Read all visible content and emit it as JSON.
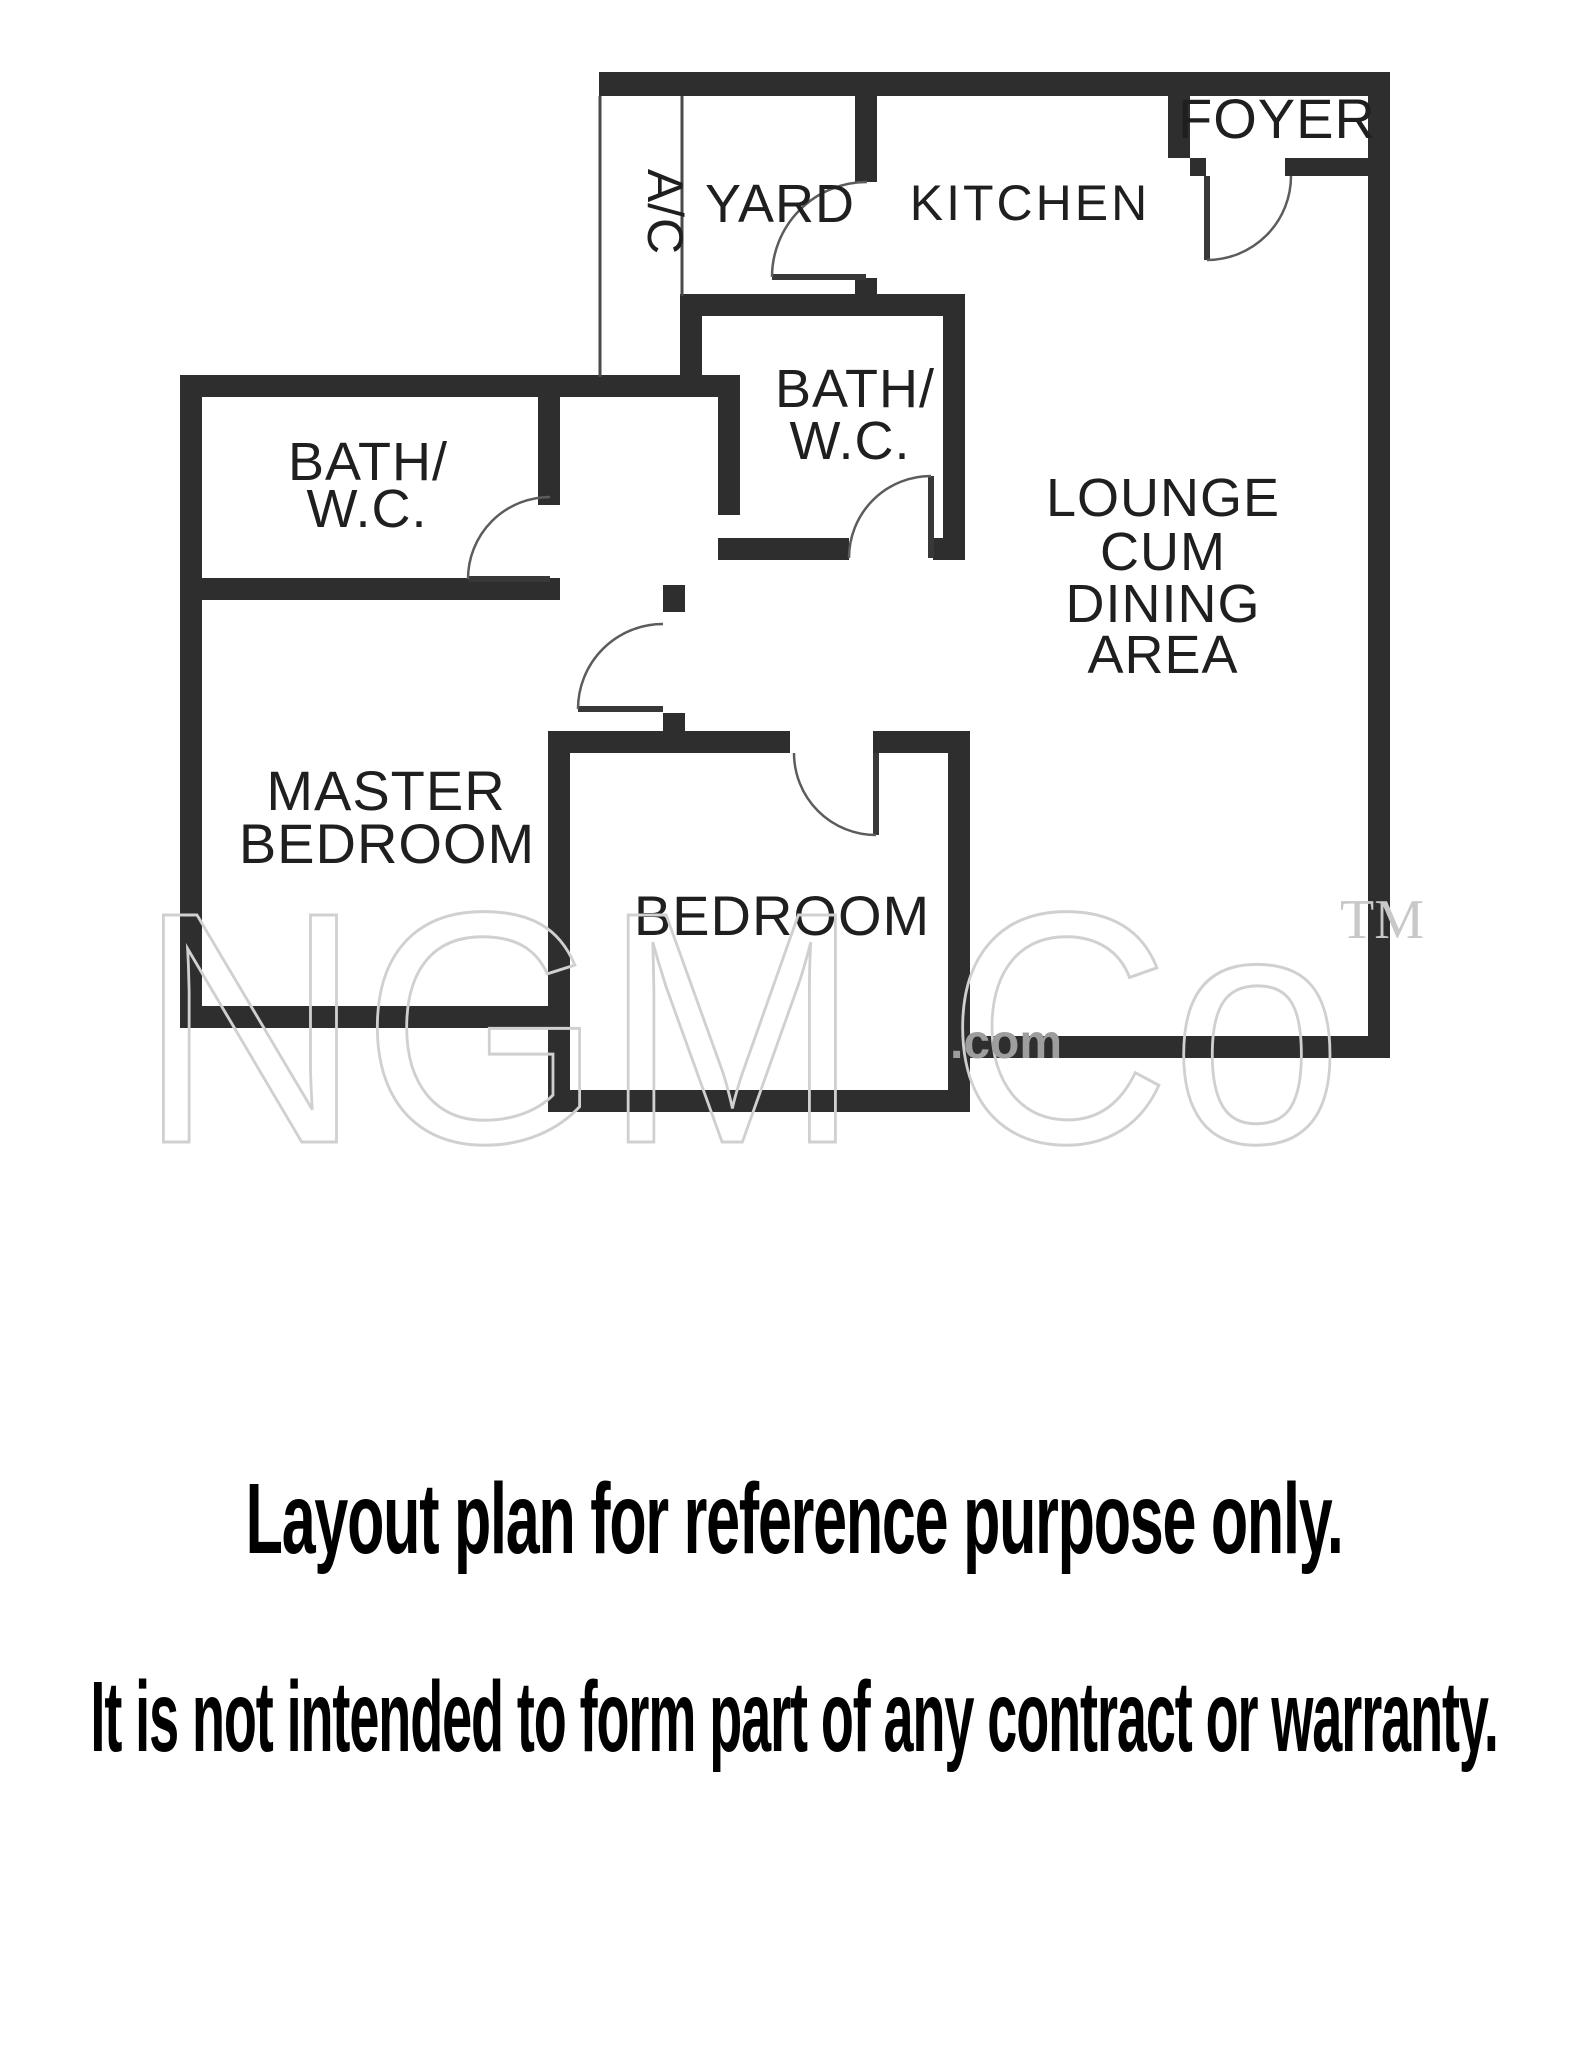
{
  "floor_plan": {
    "labels": {
      "yard": "YARD",
      "ac": "A/C",
      "kitchen": "KITCHEN",
      "foyer": "FOYER",
      "bath_top": {
        "line1": "BATH/",
        "line2": "W.C."
      },
      "bath_left": {
        "line1": "BATH/",
        "line2": "W.C."
      },
      "lounge": {
        "line1": "LOUNGE",
        "line2": "CUM",
        "line3": "DINING",
        "line4": "AREA"
      },
      "master": {
        "line1": "MASTER",
        "line2": "BEDROOM"
      },
      "bedroom": "BEDROOM"
    },
    "colors": {
      "wall": "#2e2e2e",
      "label": "#1f1f1f",
      "door_arc": "#5c5c5c",
      "watermark": "#d0d0d0"
    }
  },
  "watermark": {
    "brand": "NGM Co",
    "domain": ".com",
    "tm": "TM"
  },
  "captions": {
    "line1": "Layout plan for reference purpose only.",
    "line2": "It is not intended to form part of any contract or warranty."
  }
}
